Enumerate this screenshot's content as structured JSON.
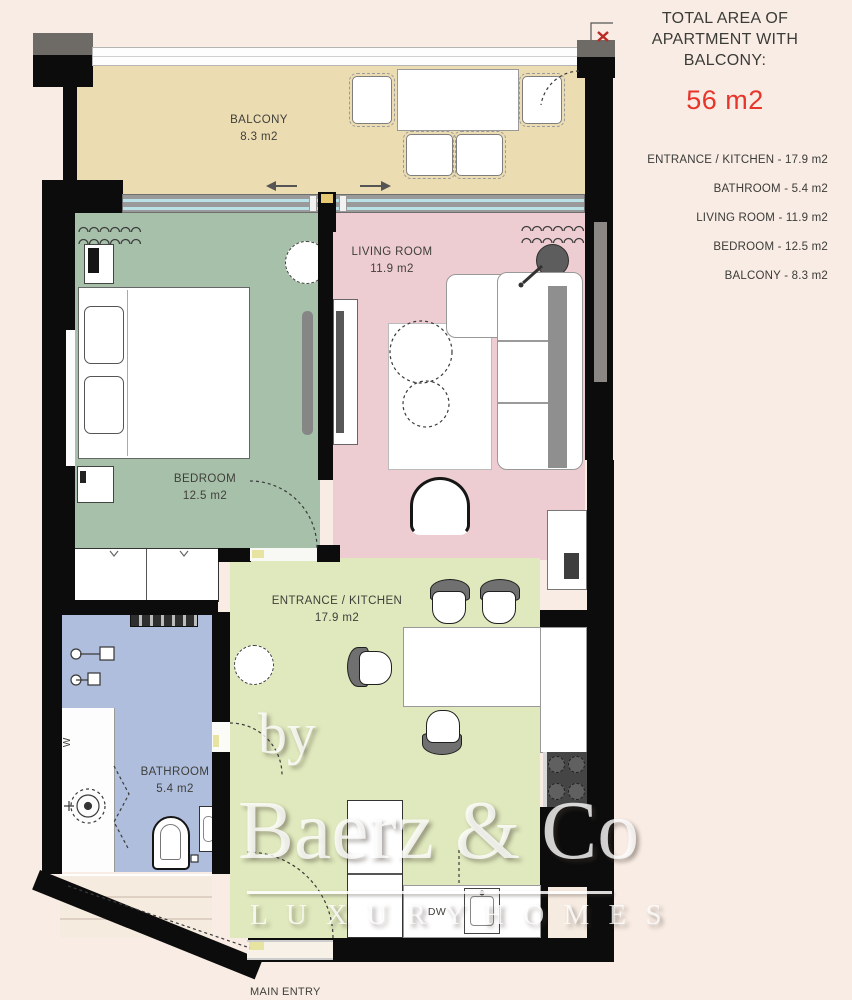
{
  "page": {
    "background": "#f8ece4"
  },
  "info_panel": {
    "title": "TOTAL AREA OF APARTMENT WITH BALCONY:",
    "total_area": "56 m2",
    "accent_color": "#e7352b",
    "room_list": [
      "ENTRANCE / KITCHEN - 17.9 m2",
      "BATHROOM - 5.4 m2",
      "LIVING ROOM - 11.9 m2",
      "BEDROOM - 12.5 m2",
      "BALCONY - 8.3 m2"
    ]
  },
  "rooms": {
    "balcony": {
      "name": "BALCONY",
      "area": "8.3 m2",
      "color": "#ecdcb2"
    },
    "bedroom": {
      "name": "BEDROOM",
      "area": "12.5 m2",
      "color": "#a7c0aa"
    },
    "living_room": {
      "name": "LIVING ROOM",
      "area": "11.9 m2",
      "color": "#eecdd2"
    },
    "entrance_kitchen": {
      "name": "ENTRANCE / KITCHEN",
      "area": "17.9 m2",
      "color": "#dfe9bd"
    },
    "bathroom": {
      "name": "BATHROOM",
      "area": "5.4 m2",
      "color": "#afbedd"
    }
  },
  "plan_labels": {
    "main_entry": "MAIN ENTRY",
    "dishwasher": "DW",
    "washer": "W"
  },
  "watermark": {
    "by": "by",
    "brand": "Baerz & Co",
    "tagline": "L U X U R Y   H O M E S"
  }
}
